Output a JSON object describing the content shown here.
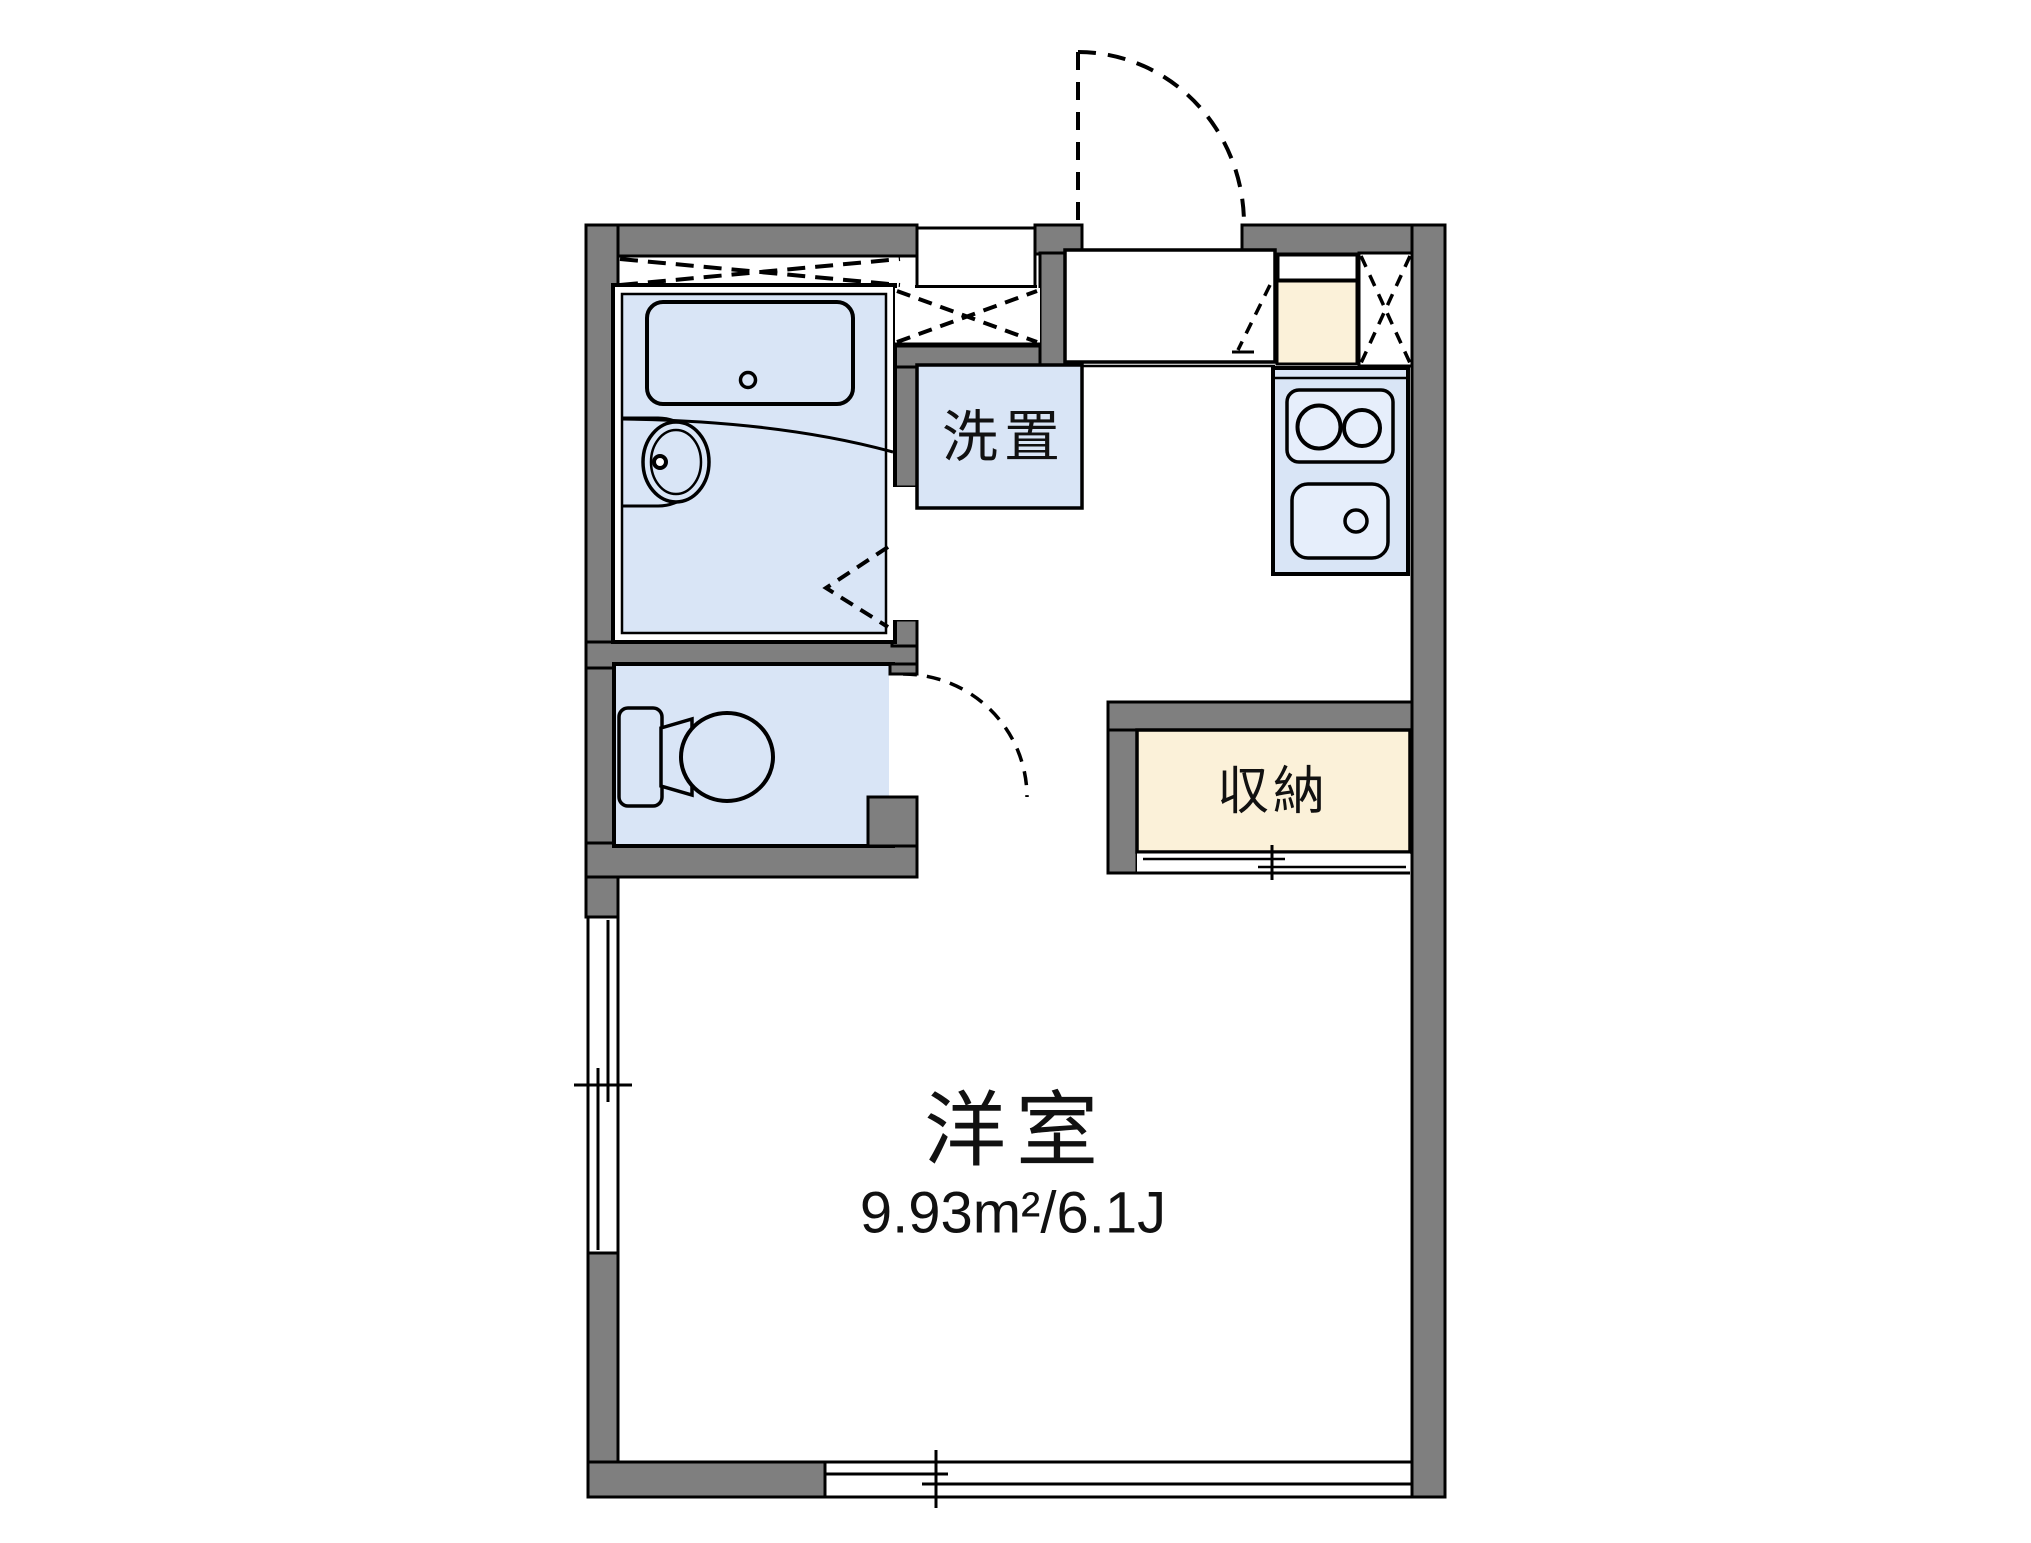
{
  "floor_plan": {
    "labels": {
      "main_room_name": "洋室",
      "main_room_area": "9.93m²/6.1J",
      "washer_space": "洗置",
      "storage": "収納"
    },
    "colors": {
      "wall_gray": "#7f7f7f",
      "room_fill_blue": "#d9e5f6",
      "fixture_fill_blue": "#e6eefb",
      "storage_fill_cream": "#fbf1d9",
      "outline_black": "#000000",
      "text_black": "#111111",
      "background": "#ffffff"
    }
  }
}
